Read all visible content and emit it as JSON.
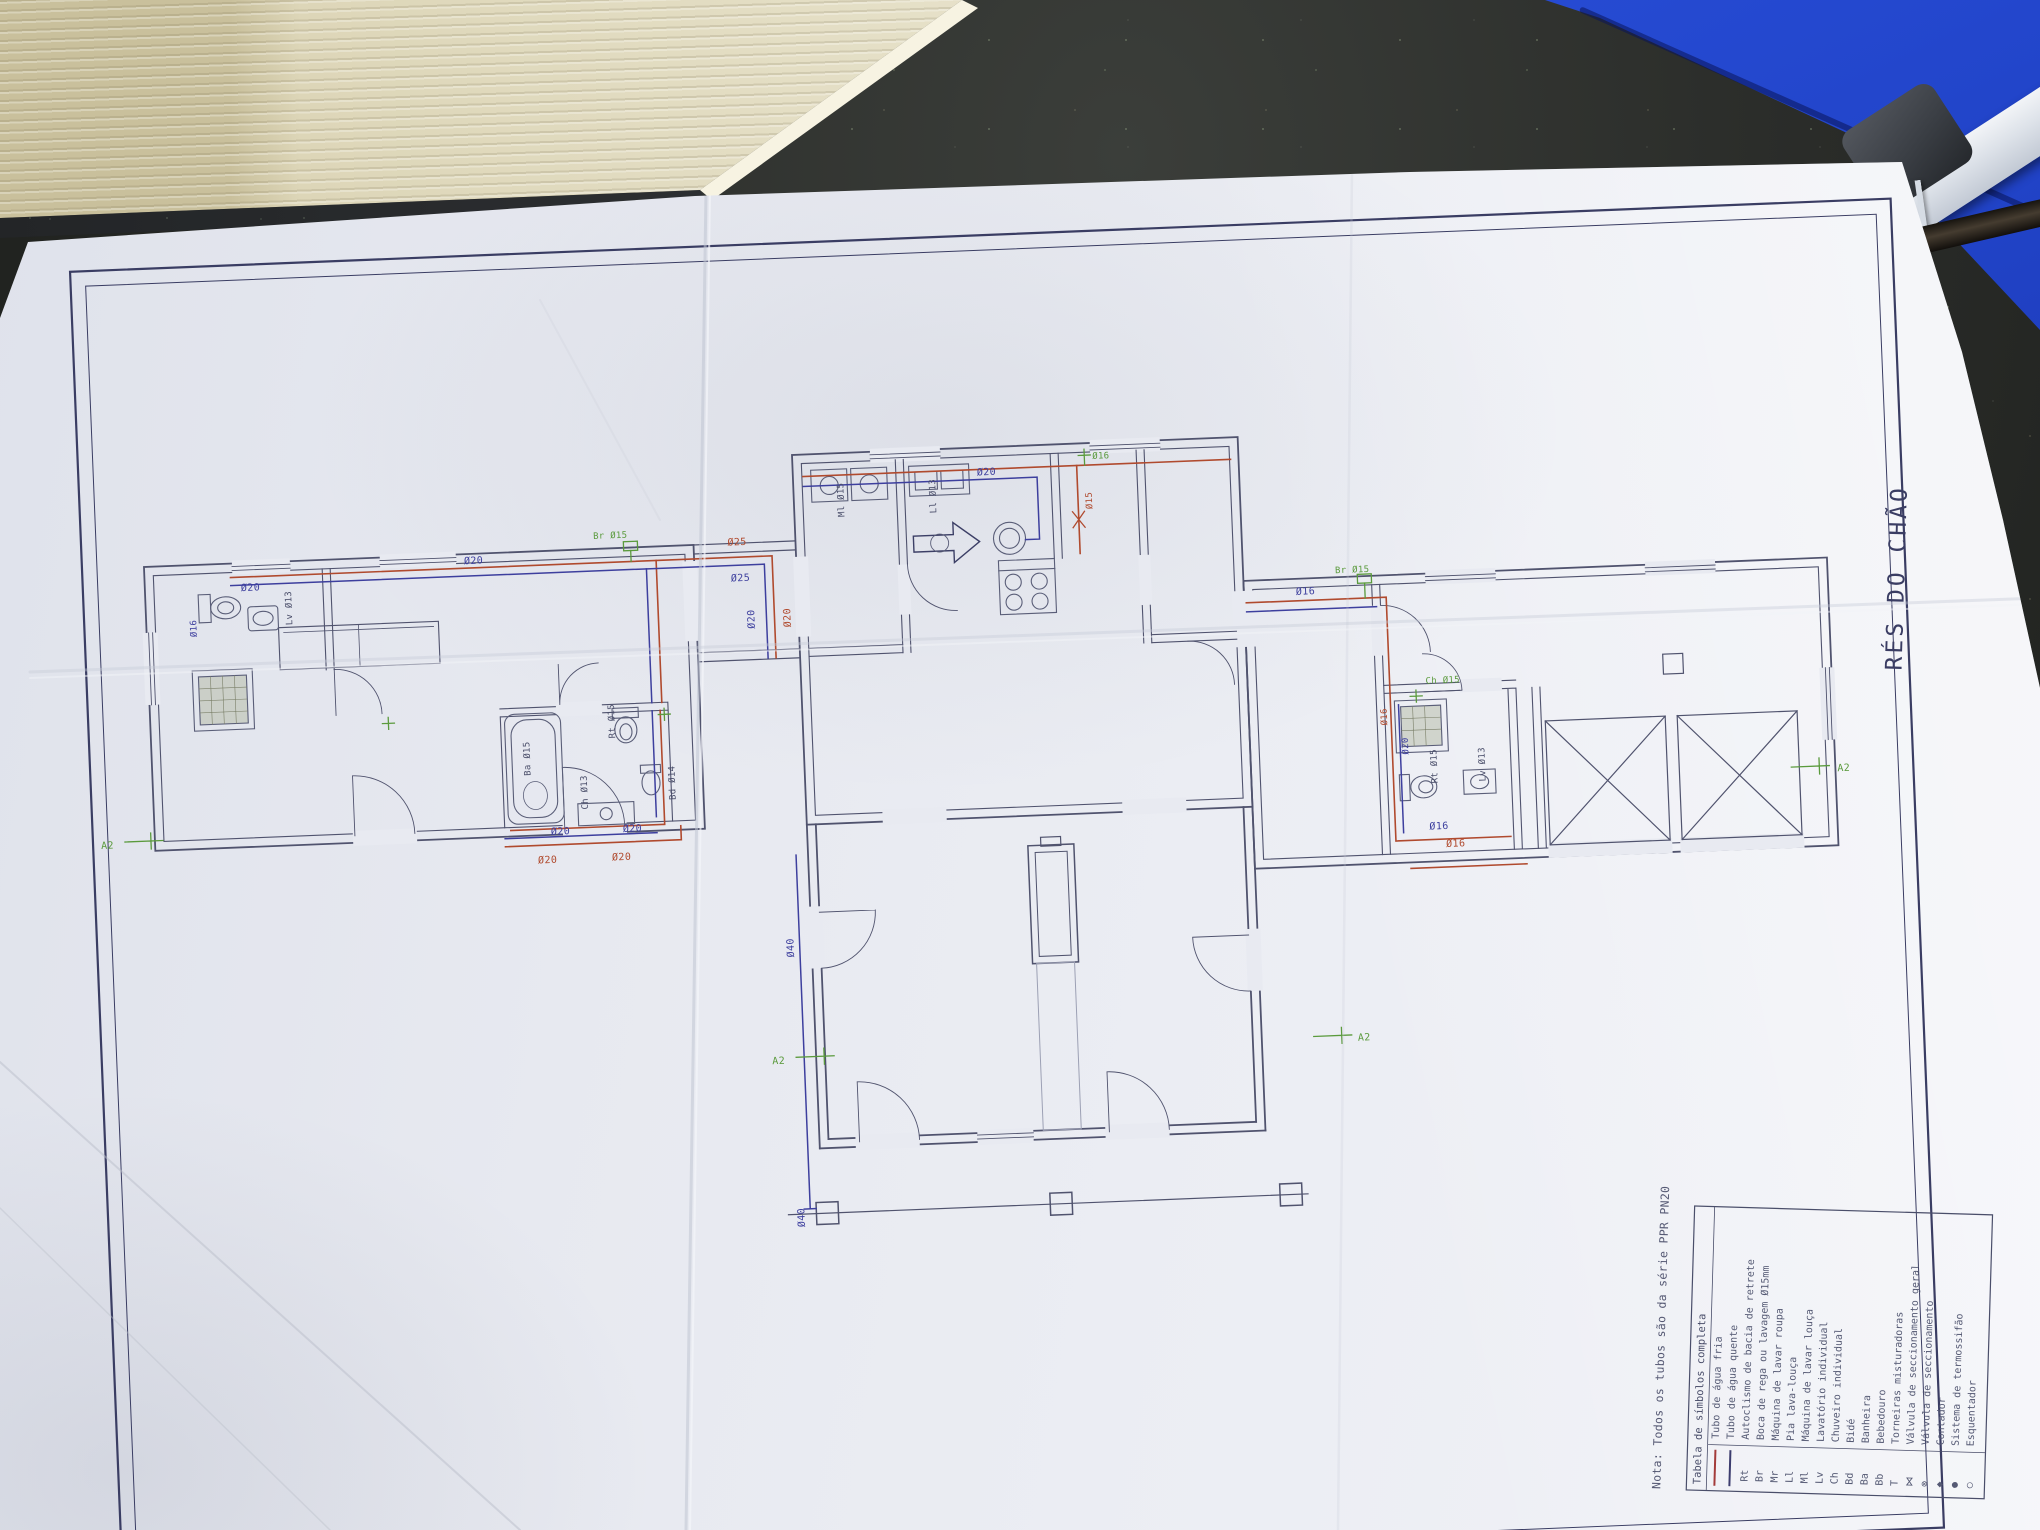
{
  "drawing": {
    "title": "RÉS DO CHÃO",
    "note": "Nota: Todos os tubos são da série PPR PN20",
    "legend": {
      "header": "Tabela de símbolos completa",
      "rows": [
        {
          "code": "",
          "label": "Tubo de água fria",
          "swatch": "#a33b3b"
        },
        {
          "code": "",
          "label": "Tubo de água quente",
          "swatch": "#3c3c6e"
        },
        {
          "code": "Rt",
          "label": "Autoclismo de bacia de retrete"
        },
        {
          "code": "Br",
          "label": "Boca de rega ou lavagem Ø15mm"
        },
        {
          "code": "Mr",
          "label": "Máquina de lavar roupa"
        },
        {
          "code": "Ll",
          "label": "Pia lava-louça"
        },
        {
          "code": "Ml",
          "label": "Máquina de lavar louça"
        },
        {
          "code": "Lv",
          "label": "Lavatório individual"
        },
        {
          "code": "Ch",
          "label": "Chuveiro individual"
        },
        {
          "code": "Bd",
          "label": "Bidé"
        },
        {
          "code": "Ba",
          "label": "Banheira"
        },
        {
          "code": "Bb",
          "label": "Bebedouro"
        },
        {
          "code": "T",
          "label": "Torneiras misturadoras"
        },
        {
          "code": "⋈",
          "label": "Válvula de seccionamento geral"
        },
        {
          "code": "⊗",
          "label": "Válvula de seccionamento"
        },
        {
          "code": "◆",
          "label": "Contador"
        },
        {
          "code": "●",
          "label": "Sistema de termossifão",
          "color": "#5a9a3c"
        },
        {
          "code": "○",
          "label": "Esquentador",
          "color": "#5a9a3c"
        }
      ]
    },
    "labels": [
      {
        "text": "Ø20",
        "color": "#3d3f9e"
      },
      {
        "text": "Ø25",
        "color": "#b04a2e"
      },
      {
        "text": "Ø25",
        "color": "#3d3f9e"
      },
      {
        "text": "Br Ø15",
        "color": "#5a9a3c"
      },
      {
        "text": "Ø20",
        "color": "#3d3f9e"
      },
      {
        "text": "Ø20",
        "color": "#b04a2e"
      },
      {
        "text": "Ø20",
        "color": "#3d3f9e"
      },
      {
        "text": "Ø16",
        "color": "#5a9a3c"
      },
      {
        "text": "Ø15",
        "color": "#b04a2e"
      },
      {
        "text": "Ø40",
        "color": "#3d3f9e"
      },
      {
        "text": "Ø40",
        "color": "#3d3f9e"
      },
      {
        "text": "A2",
        "color": "#5a9a3c"
      },
      {
        "text": "A2",
        "color": "#5a9a3c"
      },
      {
        "text": "A2",
        "color": "#5a9a3c"
      },
      {
        "text": "A2",
        "color": "#5a9a3c"
      },
      {
        "text": "Ba Ø15",
        "color": "#4a4e6a"
      },
      {
        "text": "Ch Ø13",
        "color": "#4a4e6a"
      },
      {
        "text": "Rt Ø15",
        "color": "#4a4e6a"
      },
      {
        "text": "Bd Ø14",
        "color": "#4a4e6a"
      },
      {
        "text": "Ø20",
        "color": "#3d3f9e"
      },
      {
        "text": "Ø20",
        "color": "#b04a2e"
      },
      {
        "text": "Ø20",
        "color": "#3d3f9e"
      },
      {
        "text": "Ø20",
        "color": "#b04a2e"
      },
      {
        "text": "Ø16",
        "color": "#3d3f9e"
      },
      {
        "text": "Lv Ø13",
        "color": "#4a4e6a"
      },
      {
        "text": "Ø20",
        "color": "#3d3f9e"
      },
      {
        "text": "Ml Ø15",
        "color": "#4a4e6a"
      },
      {
        "text": "Ll Ø13",
        "color": "#4a4e6a"
      },
      {
        "text": "Rt Ø15",
        "color": "#4a4e6a"
      },
      {
        "text": "Lv Ø13",
        "color": "#4a4e6a"
      },
      {
        "text": "Ch Ø15",
        "color": "#5a9a3c"
      },
      {
        "text": "Ø16",
        "color": "#b04a2e"
      },
      {
        "text": "Ø20",
        "color": "#3d3f9e"
      },
      {
        "text": "Ø16",
        "color": "#3d3f9e"
      },
      {
        "text": "Ø16",
        "color": "#b04a2e"
      },
      {
        "text": "Ø16",
        "color": "#3d3f9e"
      },
      {
        "text": "Br Ø15",
        "color": "#5a9a3c"
      }
    ]
  },
  "palette": {
    "paper": "#e7e9f0",
    "wall_ink": "#50536e",
    "border_ink": "#3a3d63",
    "pipe_cold": "#3d3f9e",
    "pipe_hot": "#b04a2e",
    "symbol_green": "#5a9a3c",
    "table_dark": "#212320",
    "folder_blue": "#2448cf",
    "cardboard": "#e8e3cc"
  }
}
